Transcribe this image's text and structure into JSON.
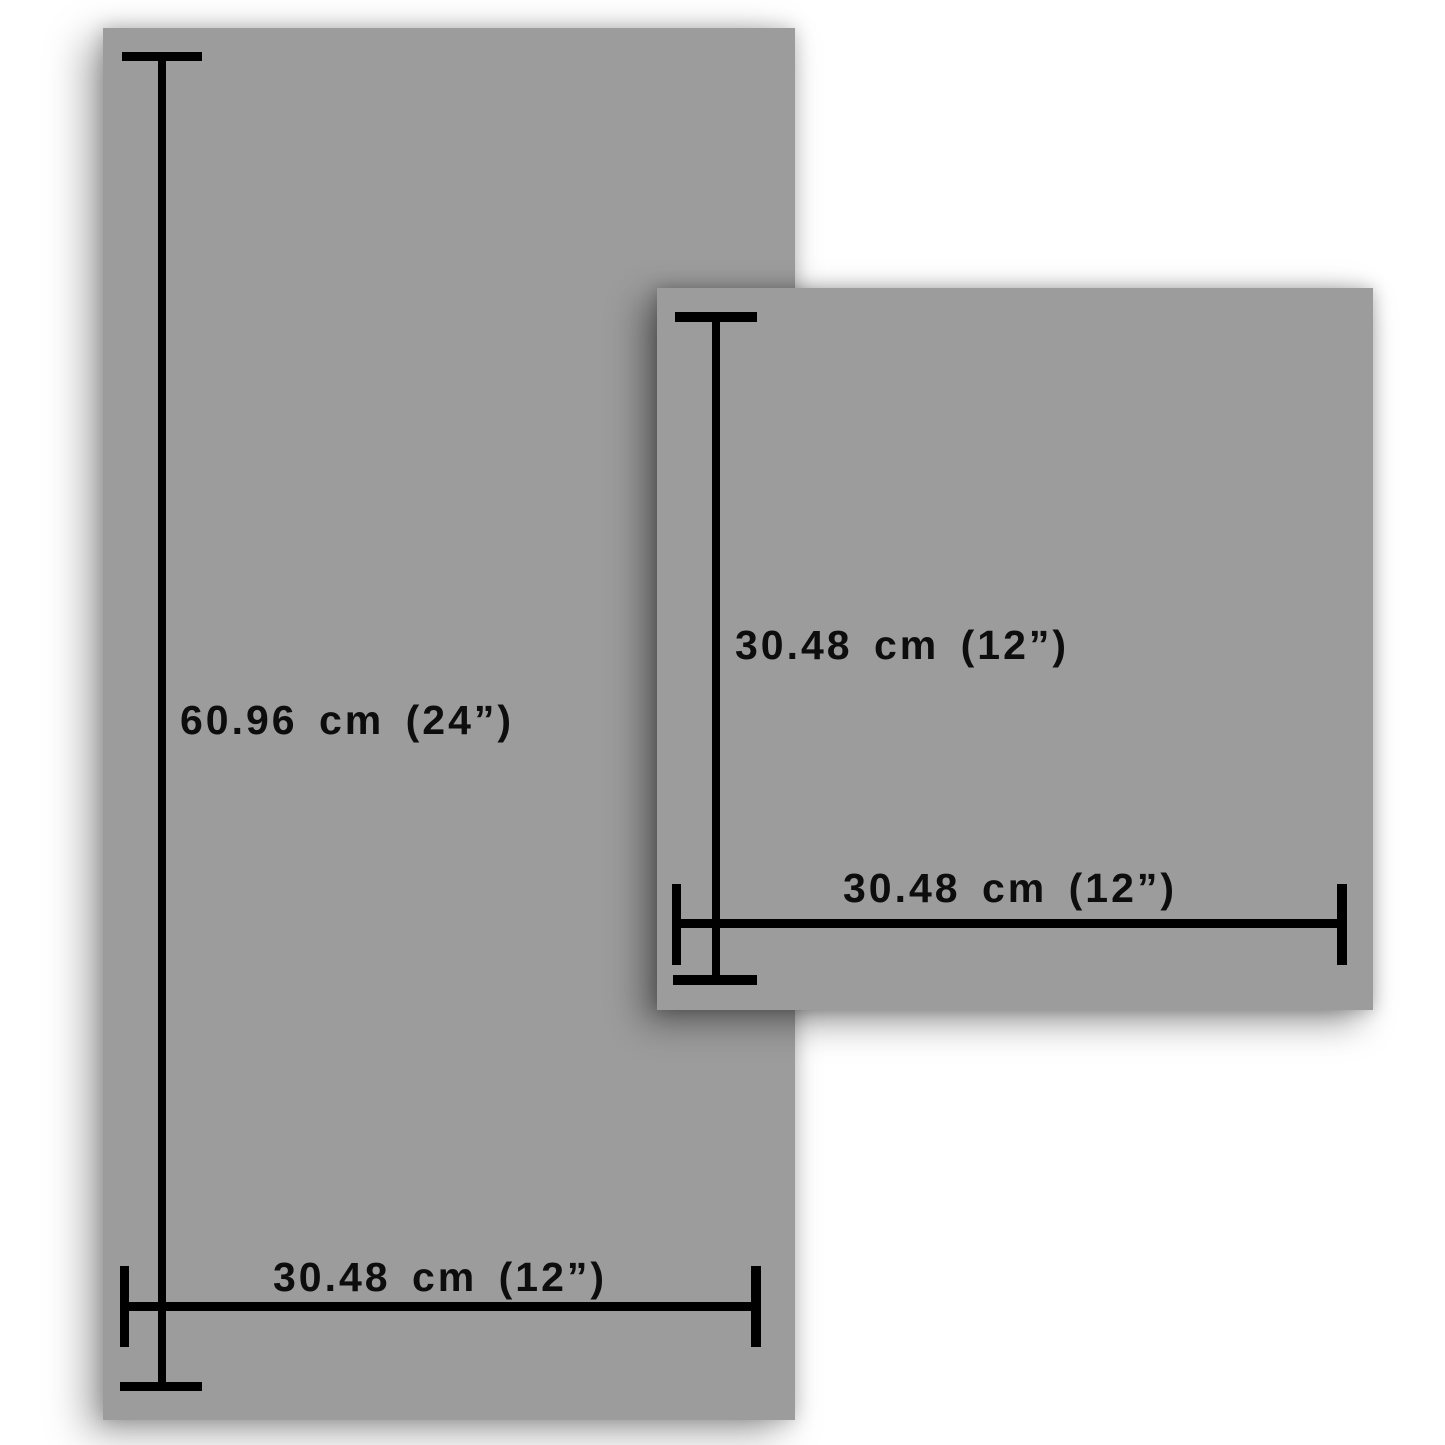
{
  "diagram": {
    "tall_panel": {
      "height_label": "60.96 cm (24”)",
      "width_label": "30.48 cm (12”)"
    },
    "square_panel": {
      "height_label": "30.48 cm (12”)",
      "width_label": "30.48 cm (12”)"
    },
    "colors": {
      "panel_fill": "#9c9c9c",
      "dimension_line": "#000000",
      "label_text": "#0d0d0d",
      "background": "#ffffff"
    }
  }
}
